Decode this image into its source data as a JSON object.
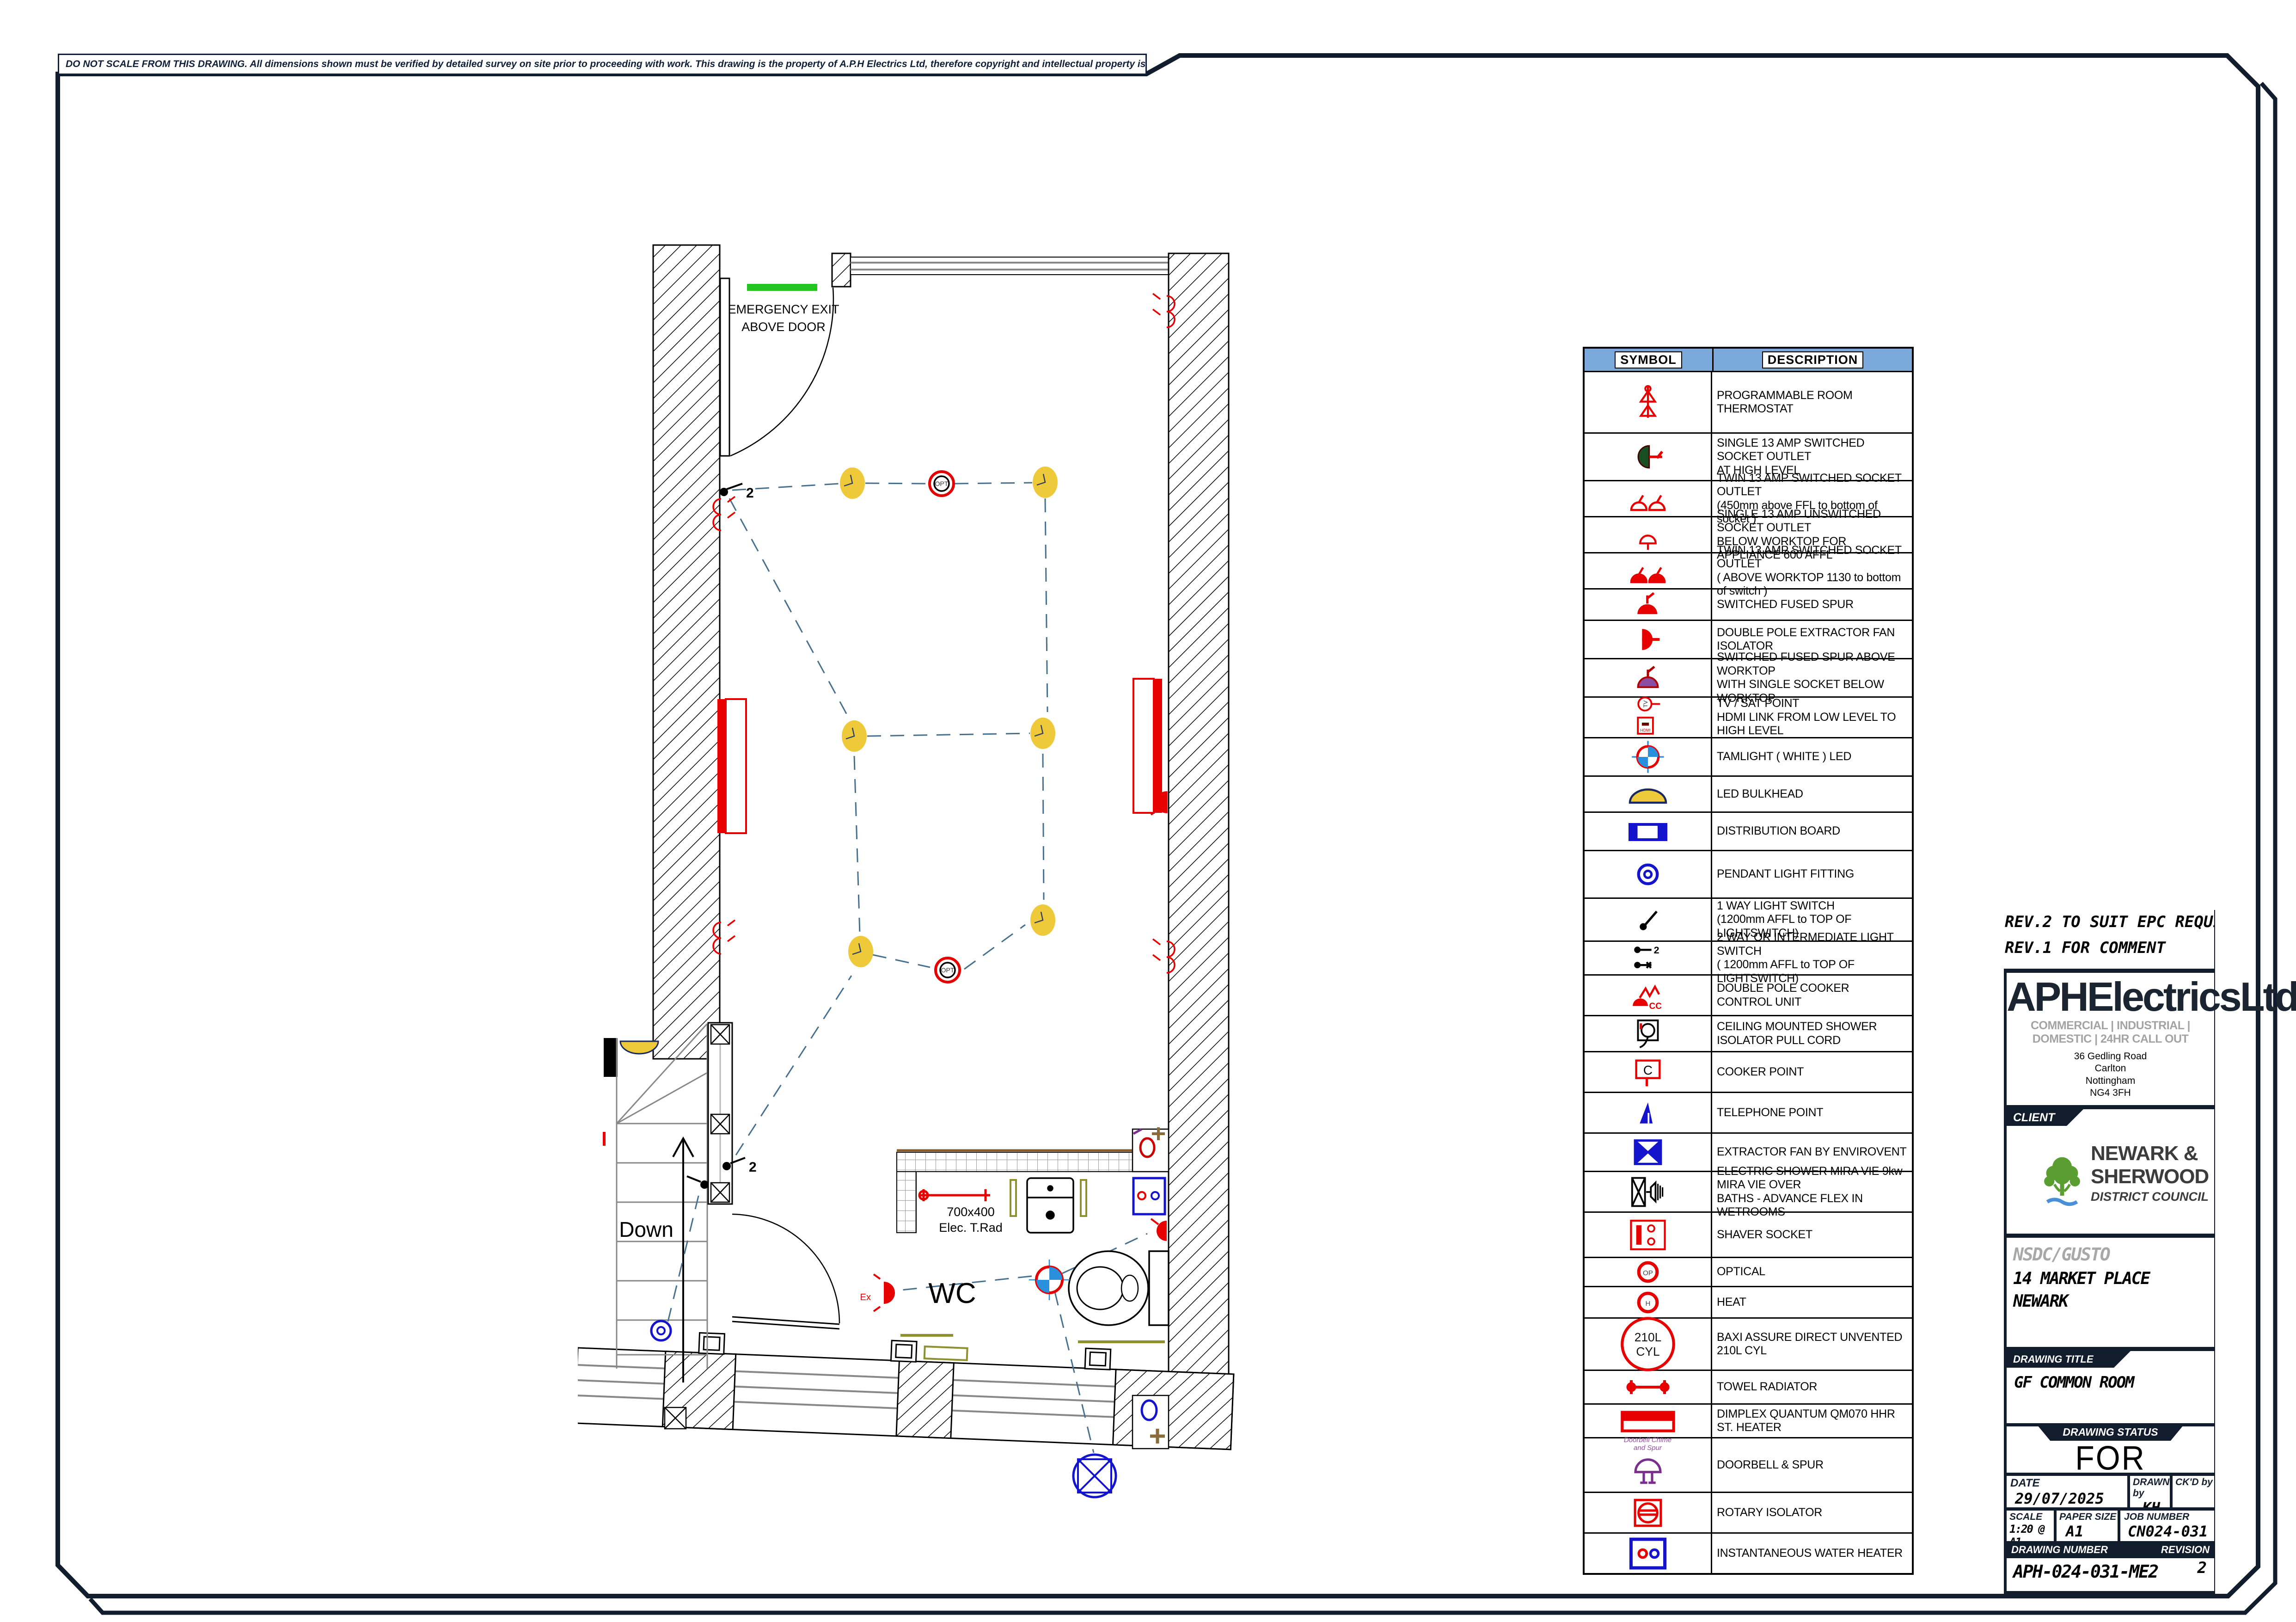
{
  "colors": {
    "frame": "#111c2c",
    "legend_header": "#7ba9dc",
    "symbol_red": "#e60000",
    "symbol_blue": "#1414cc",
    "light_yellow": "#eec93a",
    "exit_green": "#23c320",
    "rail_olive": "#8f9030",
    "accent_purple": "#7a2f8f",
    "accent_brown": "#8a6b3a",
    "logo_green": "#5a9e32",
    "logo_blue": "#4a90d9",
    "wiring_dash": "#47708e"
  },
  "disclaimer": "DO NOT SCALE FROM THIS DRAWING.  All dimensions shown must be verified by detailed survey on site prior to proceeding with work.  This drawing is the property of A.P.H Electrics Ltd, therefore copyright and intellectual property is reserved by them. The drawing is issued on condition that it is not copied, reproduced, retained or distributed to any unauthorised persons without prior written consent from A.P.H Electrics Ltd",
  "plan": {
    "labels": {
      "emergency_exit_1": "EMERGENCY EXIT",
      "emergency_exit_2": "ABOVE DOOR",
      "down": "Down",
      "wc": "WC",
      "rad_size": "700x400",
      "rad_name": "Elec. T.Rad",
      "two_way": "2",
      "opt": "OPT",
      "ex": "Ex"
    }
  },
  "legend": {
    "header": {
      "symbol": "SYMBOL",
      "description": "DESCRIPTION"
    },
    "rows": [
      {
        "symbol": "thermostat-icon",
        "lines": [
          "PROGRAMMABLE ROOM THERMOSTAT"
        ]
      },
      {
        "symbol": "single-socket-high-icon",
        "lines": [
          "SINGLE 13 AMP SWITCHED SOCKET OUTLET",
          "AT HIGH LEVEL"
        ]
      },
      {
        "symbol": "twin-socket-icon",
        "lines": [
          "TWIN 13 AMP SWITCHED SOCKET OUTLET",
          "(450mm above FFL to bottom of socket )"
        ]
      },
      {
        "symbol": "single-socket-unswitched-icon",
        "lines": [
          "SINGLE 13 AMP UNSWITCHED SOCKET OUTLET",
          "BELOW WORKTOP FOR APPLIANCE 600 AFFL"
        ]
      },
      {
        "symbol": "twin-socket-worktop-icon",
        "lines": [
          "TWIN 13 AMP SWITCHED SOCKET OUTLET",
          "( ABOVE WORKTOP 1130 to bottom of switch )"
        ]
      },
      {
        "symbol": "switched-fused-spur-icon",
        "lines": [
          "SWITCHED FUSED SPUR"
        ]
      },
      {
        "symbol": "fan-isolator-icon",
        "lines": [
          "DOUBLE POLE EXTRACTOR FAN ISOLATOR"
        ]
      },
      {
        "symbol": "fused-spur-worktop-icon",
        "lines": [
          "SWITCHED FUSED SPUR ABOVE WORKTOP",
          "WITH SINGLE SOCKET BELOW WORKTOP"
        ]
      },
      {
        "symbol": "tv-sat-icon",
        "symbol_text": [
          "TV",
          "HDMI"
        ],
        "lines": [
          "TV / SAT POINT",
          "HDMI LINK FROM LOW LEVEL TO HIGH LEVEL"
        ]
      },
      {
        "symbol": "tamlight-icon",
        "lines": [
          "TAMLIGHT   ( WHITE ) LED"
        ]
      },
      {
        "symbol": "led-bulkhead-icon",
        "lines": [
          "LED BULKHEAD"
        ]
      },
      {
        "symbol": "distribution-board-icon",
        "lines": [
          "DISTRIBUTION BOARD"
        ]
      },
      {
        "symbol": "pendant-light-icon",
        "lines": [
          "PENDANT LIGHT FITTING"
        ]
      },
      {
        "symbol": "one-way-switch-icon",
        "lines": [
          "1 WAY LIGHT SWITCH",
          "(1200mm AFFL to TOP OF LIGHTSWITCH)"
        ]
      },
      {
        "symbol": "two-way-switch-icon",
        "symbol_text": [
          "2"
        ],
        "lines": [
          "2 WAY OR  INTERMEDIATE LIGHT SWITCH",
          "( 1200mm AFFL to TOP OF LIGHTSWITCH)"
        ]
      },
      {
        "symbol": "cooker-control-icon",
        "symbol_text": [
          "CC"
        ],
        "lines": [
          "DOUBLE POLE COOKER CONTROL UNIT"
        ]
      },
      {
        "symbol": "shower-pullcord-icon",
        "lines": [
          "CEILING MOUNTED SHOWER",
          "ISOLATOR PULL CORD"
        ]
      },
      {
        "symbol": "cooker-point-icon",
        "symbol_text": [
          "C"
        ],
        "lines": [
          "COOKER POINT"
        ]
      },
      {
        "symbol": "telephone-point-icon",
        "lines": [
          "TELEPHONE POINT"
        ]
      },
      {
        "symbol": "extractor-fan-icon",
        "lines": [
          "EXTRACTOR FAN BY ENVIROVENT"
        ]
      },
      {
        "symbol": "electric-shower-icon",
        "lines": [
          "ELECTRIC SHOWER MIRA VIE 9kw MIRA VIE OVER",
          "BATHS - ADVANCE FLEX IN WETROOMS"
        ]
      },
      {
        "symbol": "shaver-socket-icon",
        "lines": [
          "SHAVER SOCKET"
        ]
      },
      {
        "symbol": "optical-icon",
        "symbol_text": [
          "OP"
        ],
        "lines": [
          "OPTICAL"
        ]
      },
      {
        "symbol": "heat-icon",
        "symbol_text": [
          "H"
        ],
        "lines": [
          "HEAT"
        ]
      },
      {
        "symbol": "cylinder-icon",
        "symbol_text": [
          "210L",
          "CYL"
        ],
        "lines": [
          "BAXI ASSURE DIRECT UNVENTED 210L CYL"
        ]
      },
      {
        "symbol": "towel-radiator-icon",
        "lines": [
          "TOWEL RADIATOR"
        ]
      },
      {
        "symbol": "dimplex-heater-icon",
        "lines": [
          "DIMPLEX QUANTUM QM070 HHR ST. HEATER"
        ]
      },
      {
        "symbol": "doorbell-icon",
        "caption": [
          "Doorbell  Chime",
          "and Spur"
        ],
        "lines": [
          "DOORBELL & SPUR"
        ]
      },
      {
        "symbol": "rotary-isolator-icon",
        "lines": [
          "ROTARY ISOLATOR"
        ]
      },
      {
        "symbol": "water-heater-icon",
        "lines": [
          "INSTANTANEOUS WATER HEATER"
        ]
      }
    ]
  },
  "title_block": {
    "revision_notes": [
      "REV.2 TO SUIT EPC REQUIREMENTS 29/",
      "REV.1 FOR COMMENT"
    ],
    "company": {
      "name": "APHElectricsLtd",
      "tagline": "COMMERCIAL | INDUSTRIAL | DOMESTIC | 24HR CALL OUT",
      "address": [
        "36 Gedling Road",
        "Carlton",
        "Nottingham",
        "NG4 3FH"
      ],
      "tel": "tel: 0115 753 0225",
      "email": "email: info@aphelectrics.co.uk"
    },
    "client": {
      "label": "CLIENT",
      "logo_line1": "NEWARK &",
      "logo_line2": "SHERWOOD",
      "logo_line3": "DISTRICT COUNCIL"
    },
    "site": {
      "ref": "NSDC/GUSTO",
      "address_line1": "14 MARKET PLACE",
      "address_line2": "NEWARK"
    },
    "drawing_title": {
      "label": "DRAWING TITLE",
      "value": "GF COMMON ROOM"
    },
    "status": {
      "label": "DRAWING STATUS",
      "value": "FOR COMMENT"
    },
    "meta": {
      "date_label": "DATE",
      "date": "29/07/2025",
      "drawn_label": "DRAWN by",
      "drawn": "KH",
      "checked_label": "CK'D by",
      "checked": "",
      "scale_label": "SCALE",
      "scale": "1:20 @ A1",
      "paper_label": "PAPER SIZE",
      "paper": "A1",
      "job_label": "JOB NUMBER",
      "job": "CN024-031",
      "number_label": "DRAWING NUMBER",
      "number": "APH-024-031-ME2",
      "revision_label": "REVISION",
      "revision": "2"
    }
  }
}
